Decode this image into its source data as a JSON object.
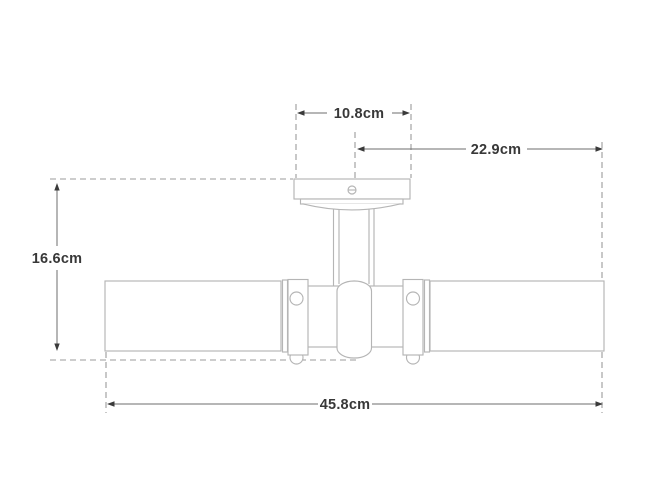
{
  "diagram": {
    "labels": {
      "canopy_width": "10.8cm",
      "center_to_end": "22.9cm",
      "overall_height": "16.6cm",
      "overall_width": "45.8cm"
    },
    "colors": {
      "fixture_outline": "#b5b5b5",
      "dashed_line": "#9b9b9b",
      "dimension_line": "#6e6e6e",
      "arrow": "#3a3a3a",
      "label_text": "#383838",
      "background": "#ffffff"
    }
  }
}
